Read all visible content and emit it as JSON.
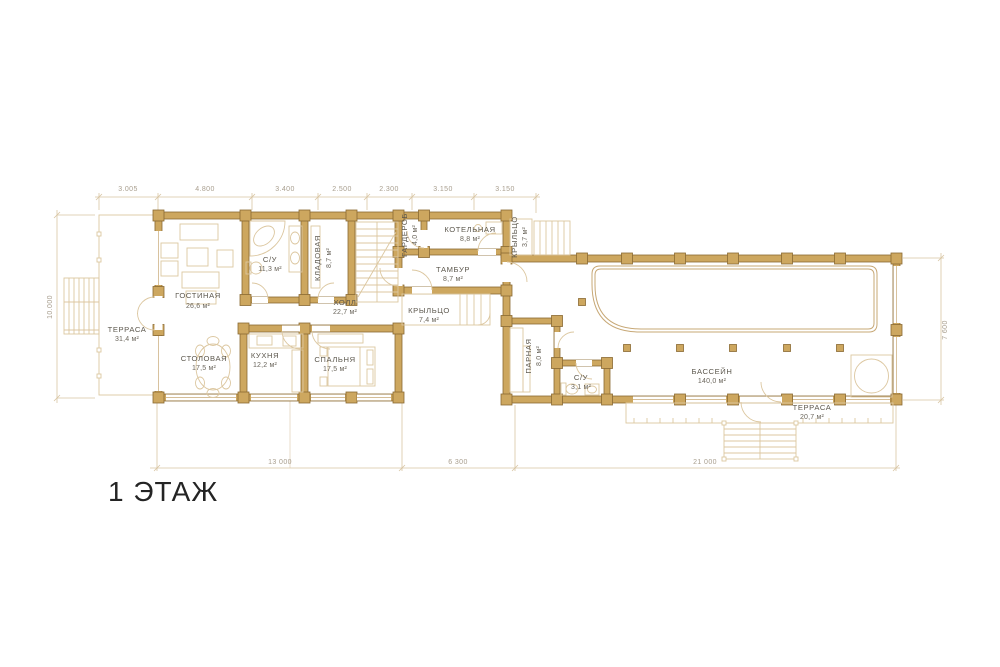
{
  "title": "1 ЭТАЖ",
  "floor_plan": {
    "rooms": {
      "terrace_left": {
        "name": "ТЕРРАСА",
        "area": "31,4 м²"
      },
      "living": {
        "name": "ГОСТИНАЯ",
        "area": "26,6 м²"
      },
      "bathroom_main": {
        "name": "С/У",
        "area": "11,3 м²"
      },
      "storage": {
        "name": "КЛАДОВАЯ",
        "area": "8,7 м²"
      },
      "hall": {
        "name": "ХОЛЛ",
        "area": "22,7 м²"
      },
      "wardrobe": {
        "name": "ГАРДЕРОБ",
        "area": "4,0 м²"
      },
      "boiler": {
        "name": "КОТЕЛЬНАЯ",
        "area": "8,8 м²"
      },
      "vestibule": {
        "name": "ТАМБУР",
        "area": "8,7 м²"
      },
      "porch_small": {
        "name": "КРЫЛЬЦО",
        "area": "3,7 м²"
      },
      "porch_main": {
        "name": "КРЫЛЬЦО",
        "area": "7,4 м²"
      },
      "dining": {
        "name": "СТОЛОВАЯ",
        "area": "17,5 м²"
      },
      "kitchen": {
        "name": "КУХНЯ",
        "area": "12,2 м²"
      },
      "bedroom": {
        "name": "СПАЛЬНЯ",
        "area": "17,5 м²"
      },
      "steam": {
        "name": "ПАРНАЯ",
        "area": "8,0 м²"
      },
      "bathroom_pool": {
        "name": "С/У",
        "area": "3,1 м²"
      },
      "pool": {
        "name": "БАССЕЙН",
        "area": "140,0 м²"
      },
      "terrace_right": {
        "name": "ТЕРРАСА",
        "area": "20,7 м²"
      }
    },
    "dimensions": {
      "top": [
        "3.005",
        "4.800",
        "3.400",
        "2.500",
        "2.300",
        "3.150",
        "3.150"
      ],
      "bottom": [
        "13 000",
        "6 300",
        "21 000"
      ],
      "left": "10.000",
      "right": "7 600"
    },
    "colors": {
      "wall": "#cda75f",
      "wall_outline": "#8a6a32",
      "light_line": "#dcc7a0",
      "pool_line": "#c7a876",
      "dim_line": "#d8c5a2",
      "dim_text": "#a89e8e",
      "room_text": "#5d584e",
      "title_text": "#242424",
      "background": "#ffffff"
    }
  }
}
